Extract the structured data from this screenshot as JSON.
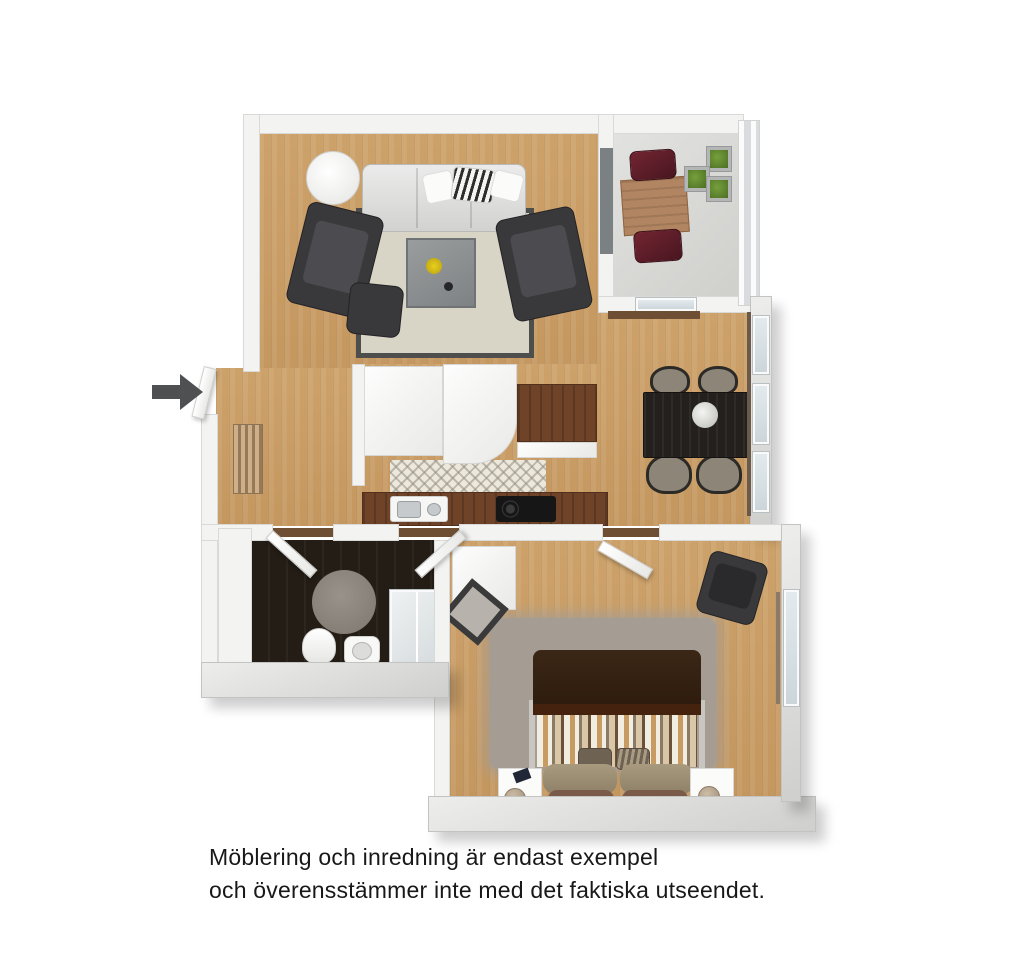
{
  "caption": {
    "line1": "Möblering och inredning är endast exempel",
    "line2": "och överensstämmer inte med det faktiska utseendet."
  },
  "entrance": {
    "arrow_direction": "right",
    "arrow_color": "#4e5052"
  },
  "palette": {
    "background": "#ffffff",
    "wall": "#f3f3f1",
    "wall_exterior": "#d5d5d3",
    "floor_wood": "#c89c63",
    "floor_bathroom": "#241d16",
    "floor_balcony": "#d8d8d5",
    "living_rug": "#d8d4c6",
    "bedroom_rug": "#a59c93",
    "sofa": "#dcdcdc",
    "armchair": "#39393c",
    "coffee_table": "#8d9192",
    "dining_table": "#23201d",
    "balcony_chair": "#5a1e28",
    "balcony_table": "#b18561",
    "planter_green": "#5e8530",
    "bed_blanket": "#342112",
    "kitchen_counter": "#6e4328"
  },
  "rooms": {
    "living_room": {
      "furniture": [
        "floor-lamp",
        "sofa",
        "throw-pillows",
        "armchair-left",
        "armchair-right",
        "ottoman",
        "coffee-table",
        "area-rug"
      ]
    },
    "balcony": {
      "furniture": [
        "wood-table",
        "red-chair-top",
        "red-chair-bottom",
        "planters",
        "railing"
      ]
    },
    "dining_area": {
      "furniture": [
        "dining-table",
        "four-chairs",
        "flower-centerpiece",
        "windows"
      ]
    },
    "kitchen": {
      "furniture": [
        "cabinets",
        "corner-cabinet",
        "wood-counter",
        "sink",
        "cooktop",
        "runner-rug"
      ]
    },
    "hallway": {
      "furniture": [
        "entrance-door",
        "radiator"
      ]
    },
    "bathroom": {
      "furniture": [
        "toilet",
        "sink",
        "shower",
        "round-rug",
        "doors"
      ]
    },
    "bedroom": {
      "furniture": [
        "double-bed",
        "striped-duvet",
        "nightstand-left",
        "nightstand-right",
        "table-lamps",
        "leaning-mirror",
        "dresser",
        "armchair",
        "shag-rug",
        "window"
      ]
    }
  }
}
